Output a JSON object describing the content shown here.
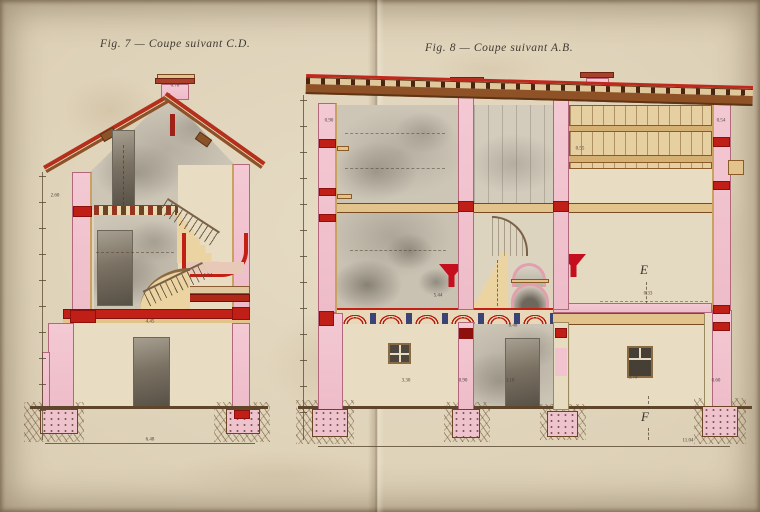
{
  "figures": [
    {
      "id": "fig7",
      "title": "Fig. 7 — Coupe suivant C.D."
    },
    {
      "id": "fig8",
      "title": "Fig. 8 — Coupe suivant A.B."
    }
  ],
  "markers": {
    "e": "E",
    "f": "F"
  },
  "dimension_labels": [
    {
      "text": "0.78",
      "x": 175,
      "y": 86
    },
    {
      "text": "2.60",
      "x": 55,
      "y": 196
    },
    {
      "text": "1.54",
      "x": 208,
      "y": 276
    },
    {
      "text": "4.45",
      "x": 150,
      "y": 322
    },
    {
      "text": "6.48",
      "x": 150,
      "y": 440
    },
    {
      "text": "0.90",
      "x": 329,
      "y": 121
    },
    {
      "text": "0.54",
      "x": 721,
      "y": 121
    },
    {
      "text": "0.55",
      "x": 580,
      "y": 149
    },
    {
      "text": "5.44",
      "x": 438,
      "y": 296
    },
    {
      "text": "0.33",
      "x": 648,
      "y": 294
    },
    {
      "text": "8.48",
      "x": 513,
      "y": 326
    },
    {
      "text": "3.30",
      "x": 406,
      "y": 381
    },
    {
      "text": "0.90",
      "x": 463,
      "y": 381
    },
    {
      "text": "3.10",
      "x": 510,
      "y": 381
    },
    {
      "text": "3.70",
      "x": 633,
      "y": 378
    },
    {
      "text": "0.60",
      "x": 716,
      "y": 381
    },
    {
      "text": "11.04",
      "x": 688,
      "y": 441
    }
  ],
  "colors": {
    "paper": "#d9ccb2",
    "pink": "#f1c3ce",
    "pinkDark": "#b2677d",
    "red": "#bf1f16",
    "darkRed": "#8e100c",
    "roofRed": "#b5301c",
    "brown": "#8a5428",
    "tan": "#e2c38c",
    "tanDark": "#c9a261",
    "cream": "#e8ddc2",
    "ink": "#463f36",
    "blue": "#27336f",
    "ground": "#5f452a",
    "wash": "#cdc6b7",
    "washDark": "#6e675c"
  }
}
